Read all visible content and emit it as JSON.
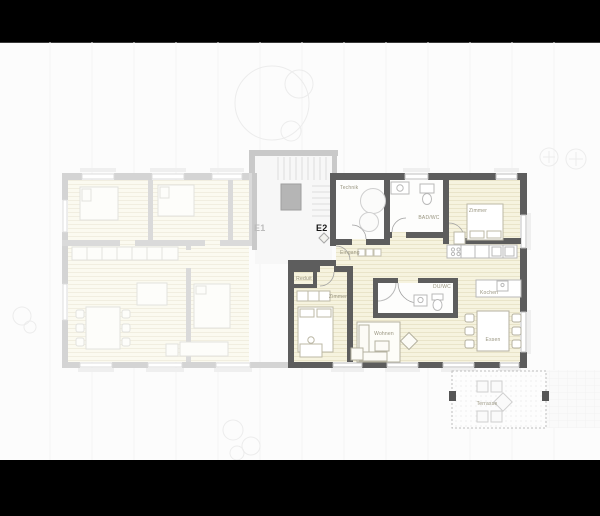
{
  "plan": {
    "units": [
      {
        "id": "E1",
        "label": "E1",
        "state": "inactive"
      },
      {
        "id": "E2",
        "label": "E2",
        "state": "active"
      }
    ],
    "rooms_e2": {
      "technik": "Technik",
      "bad_wc": "BAD/WC",
      "zimmer_top": "Zimmer",
      "eingang": "Eingang",
      "reduit": "Reduit",
      "zimmer_lower": "Zimmer",
      "du_wc": "DU/WC",
      "kochen": "Kochen",
      "wohnen": "Wohnen",
      "essen": "Essen",
      "terrasse": "Terrasse"
    },
    "colors": {
      "frame": "#000000",
      "paper": "#fcfcfc",
      "wall_active": "#5d5d5d",
      "wall_faded": "#d4d4d4",
      "floor_active": "#f6f3df",
      "floor_faded": "#fbfaf0",
      "label_gray": "#98947f"
    }
  }
}
